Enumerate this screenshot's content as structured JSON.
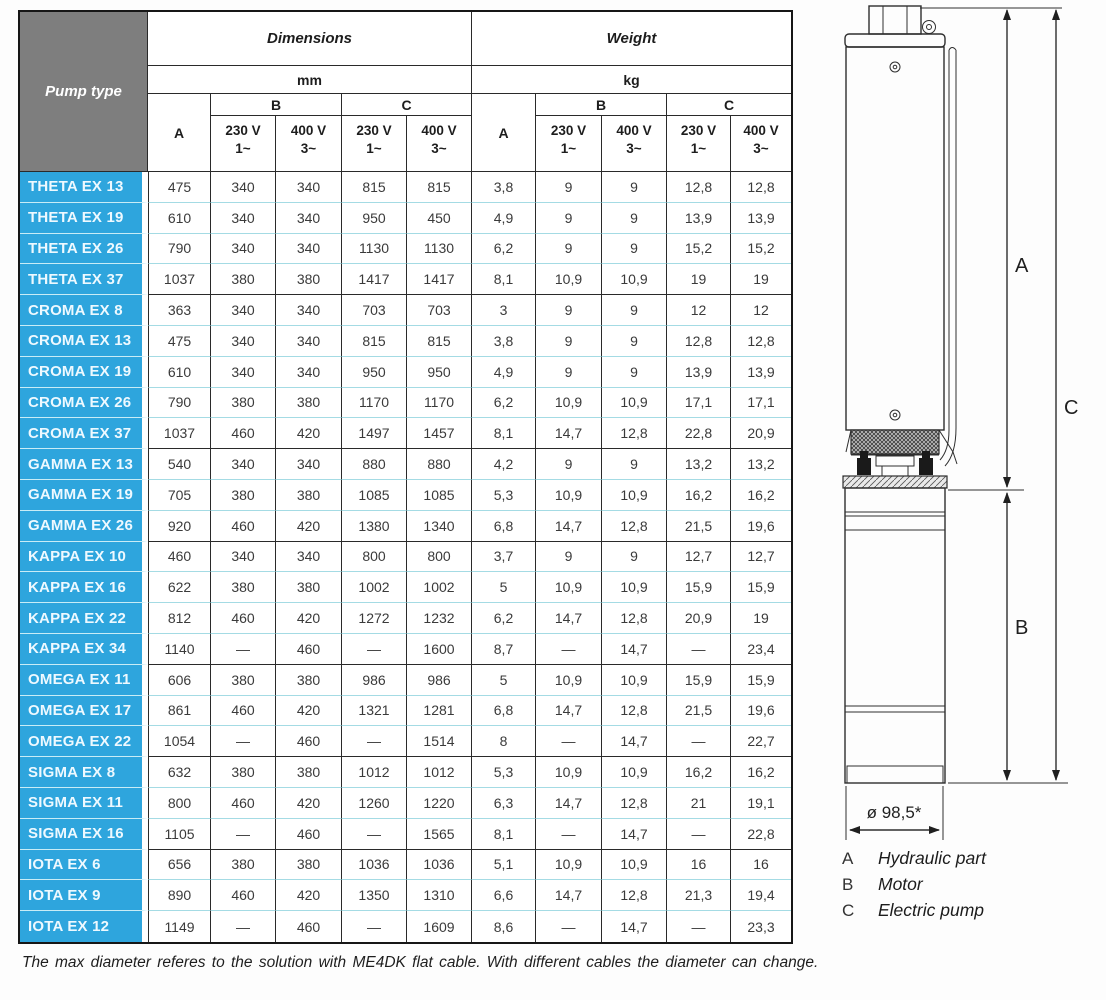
{
  "header": {
    "pump_type": "Pump type",
    "dimensions": "Dimensions",
    "weight": "Weight",
    "unit_mm": "mm",
    "unit_kg": "kg",
    "col_a": "A",
    "col_b": "B",
    "col_c": "C",
    "volt_230": "230 V",
    "phase_1": "1~",
    "volt_400": "400 V",
    "phase_3": "3~"
  },
  "rows": [
    {
      "group": "THETA",
      "name": "THETA EX 13",
      "dim": [
        "475",
        "340",
        "340",
        "815",
        "815"
      ],
      "wt": [
        "3,8",
        "9",
        "9",
        "12,8",
        "12,8"
      ]
    },
    {
      "group": "THETA",
      "name": "THETA EX 19",
      "dim": [
        "610",
        "340",
        "340",
        "950",
        "450"
      ],
      "wt": [
        "4,9",
        "9",
        "9",
        "13,9",
        "13,9"
      ]
    },
    {
      "group": "THETA",
      "name": "THETA EX 26",
      "dim": [
        "790",
        "340",
        "340",
        "1130",
        "1130"
      ],
      "wt": [
        "6,2",
        "9",
        "9",
        "15,2",
        "15,2"
      ]
    },
    {
      "group": "THETA",
      "name": "THETA EX 37",
      "dim": [
        "1037",
        "380",
        "380",
        "1417",
        "1417"
      ],
      "wt": [
        "8,1",
        "10,9",
        "10,9",
        "19",
        "19"
      ]
    },
    {
      "group": "CROMA",
      "name": "CROMA EX 8",
      "dim": [
        "363",
        "340",
        "340",
        "703",
        "703"
      ],
      "wt": [
        "3",
        "9",
        "9",
        "12",
        "12"
      ]
    },
    {
      "group": "CROMA",
      "name": "CROMA EX 13",
      "dim": [
        "475",
        "340",
        "340",
        "815",
        "815"
      ],
      "wt": [
        "3,8",
        "9",
        "9",
        "12,8",
        "12,8"
      ]
    },
    {
      "group": "CROMA",
      "name": "CROMA EX 19",
      "dim": [
        "610",
        "340",
        "340",
        "950",
        "950"
      ],
      "wt": [
        "4,9",
        "9",
        "9",
        "13,9",
        "13,9"
      ]
    },
    {
      "group": "CROMA",
      "name": "CROMA EX 26",
      "dim": [
        "790",
        "380",
        "380",
        "1170",
        "1170"
      ],
      "wt": [
        "6,2",
        "10,9",
        "10,9",
        "17,1",
        "17,1"
      ]
    },
    {
      "group": "CROMA",
      "name": "CROMA EX 37",
      "dim": [
        "1037",
        "460",
        "420",
        "1497",
        "1457"
      ],
      "wt": [
        "8,1",
        "14,7",
        "12,8",
        "22,8",
        "20,9"
      ]
    },
    {
      "group": "GAMMA",
      "name": "GAMMA EX 13",
      "dim": [
        "540",
        "340",
        "340",
        "880",
        "880"
      ],
      "wt": [
        "4,2",
        "9",
        "9",
        "13,2",
        "13,2"
      ]
    },
    {
      "group": "GAMMA",
      "name": "GAMMA EX 19",
      "dim": [
        "705",
        "380",
        "380",
        "1085",
        "1085"
      ],
      "wt": [
        "5,3",
        "10,9",
        "10,9",
        "16,2",
        "16,2"
      ]
    },
    {
      "group": "GAMMA",
      "name": "GAMMA EX 26",
      "dim": [
        "920",
        "460",
        "420",
        "1380",
        "1340"
      ],
      "wt": [
        "6,8",
        "14,7",
        "12,8",
        "21,5",
        "19,6"
      ]
    },
    {
      "group": "KAPPA",
      "name": "KAPPA EX 10",
      "dim": [
        "460",
        "340",
        "340",
        "800",
        "800"
      ],
      "wt": [
        "3,7",
        "9",
        "9",
        "12,7",
        "12,7"
      ]
    },
    {
      "group": "KAPPA",
      "name": "KAPPA EX 16",
      "dim": [
        "622",
        "380",
        "380",
        "1002",
        "1002"
      ],
      "wt": [
        "5",
        "10,9",
        "10,9",
        "15,9",
        "15,9"
      ]
    },
    {
      "group": "KAPPA",
      "name": "KAPPA EX 22",
      "dim": [
        "812",
        "460",
        "420",
        "1272",
        "1232"
      ],
      "wt": [
        "6,2",
        "14,7",
        "12,8",
        "20,9",
        "19"
      ]
    },
    {
      "group": "KAPPA",
      "name": "KAPPA EX 34",
      "dim": [
        "1140",
        "—",
        "460",
        "—",
        "1600"
      ],
      "wt": [
        "8,7",
        "—",
        "14,7",
        "—",
        "23,4"
      ]
    },
    {
      "group": "OMEGA",
      "name": "OMEGA EX 11",
      "dim": [
        "606",
        "380",
        "380",
        "986",
        "986"
      ],
      "wt": [
        "5",
        "10,9",
        "10,9",
        "15,9",
        "15,9"
      ]
    },
    {
      "group": "OMEGA",
      "name": "OMEGA EX 17",
      "dim": [
        "861",
        "460",
        "420",
        "1321",
        "1281"
      ],
      "wt": [
        "6,8",
        "14,7",
        "12,8",
        "21,5",
        "19,6"
      ]
    },
    {
      "group": "OMEGA",
      "name": "OMEGA EX 22",
      "dim": [
        "1054",
        "—",
        "460",
        "—",
        "1514"
      ],
      "wt": [
        "8",
        "—",
        "14,7",
        "—",
        "22,7"
      ]
    },
    {
      "group": "SIGMA",
      "name": "SIGMA EX 8",
      "dim": [
        "632",
        "380",
        "380",
        "1012",
        "1012"
      ],
      "wt": [
        "5,3",
        "10,9",
        "10,9",
        "16,2",
        "16,2"
      ]
    },
    {
      "group": "SIGMA",
      "name": "SIGMA EX 11",
      "dim": [
        "800",
        "460",
        "420",
        "1260",
        "1220"
      ],
      "wt": [
        "6,3",
        "14,7",
        "12,8",
        "21",
        "19,1"
      ]
    },
    {
      "group": "SIGMA",
      "name": "SIGMA EX 16",
      "dim": [
        "1105",
        "—",
        "460",
        "—",
        "1565"
      ],
      "wt": [
        "8,1",
        "—",
        "14,7",
        "—",
        "22,8"
      ]
    },
    {
      "group": "IOTA",
      "name": "IOTA EX 6",
      "dim": [
        "656",
        "380",
        "380",
        "1036",
        "1036"
      ],
      "wt": [
        "5,1",
        "10,9",
        "10,9",
        "16",
        "16"
      ]
    },
    {
      "group": "IOTA",
      "name": "IOTA EX 9",
      "dim": [
        "890",
        "460",
        "420",
        "1350",
        "1310"
      ],
      "wt": [
        "6,6",
        "14,7",
        "12,8",
        "21,3",
        "19,4"
      ]
    },
    {
      "group": "IOTA",
      "name": "IOTA EX 12",
      "dim": [
        "1149",
        "—",
        "460",
        "—",
        "1609"
      ],
      "wt": [
        "8,6",
        "—",
        "14,7",
        "—",
        "23,3"
      ]
    }
  ],
  "diagram": {
    "label_a": "A",
    "label_b": "B",
    "label_c": "C",
    "diameter": "ø 98,5*",
    "legend": [
      {
        "key": "A",
        "label": "Hydraulic part"
      },
      {
        "key": "B",
        "label": "Motor"
      },
      {
        "key": "C",
        "label": "Electric pump"
      }
    ]
  },
  "footer": "The max diameter referes to the solution with ME4DK flat cable. With different cables the diameter can change.",
  "colors": {
    "accent_blue": "#2ea5dd",
    "header_gray": "#7e7e7e",
    "light_separator": "#a4dbe4",
    "border_dark": "#2a2a2a"
  }
}
